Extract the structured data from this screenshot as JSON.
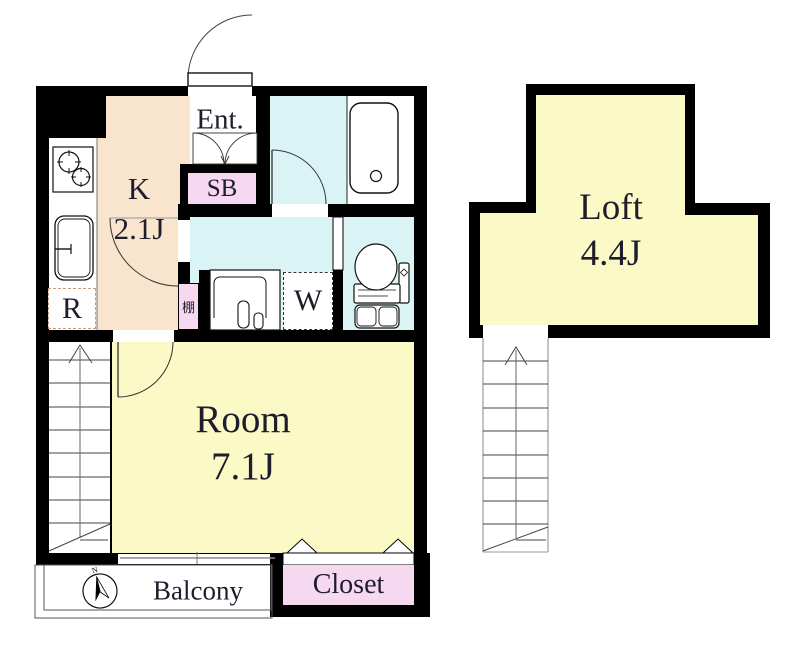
{
  "plan": {
    "entrance": {
      "label": "Ent."
    },
    "kitchen": {
      "label": "K",
      "size": "2.1J"
    },
    "shoe_box": {
      "label": "SB"
    },
    "refrigerator": {
      "label": "R"
    },
    "shelf": {
      "label": "棚"
    },
    "washing_machine": {
      "label": "W"
    },
    "main_room": {
      "label": "Room",
      "size": "7.1J"
    },
    "loft": {
      "label": "Loft",
      "size": "4.4J"
    },
    "balcony": {
      "label": "Balcony"
    },
    "closet": {
      "label": "Closet"
    },
    "compass": {
      "north": "N"
    }
  },
  "colors": {
    "wall": "#000000",
    "kitchen_floor": "#F9E4CD",
    "room_floor": "#FBF9C5",
    "wet_area_floor": "#DAF3F5",
    "storage_pink": "#F7D8F1",
    "white": "#FFFFFF"
  }
}
